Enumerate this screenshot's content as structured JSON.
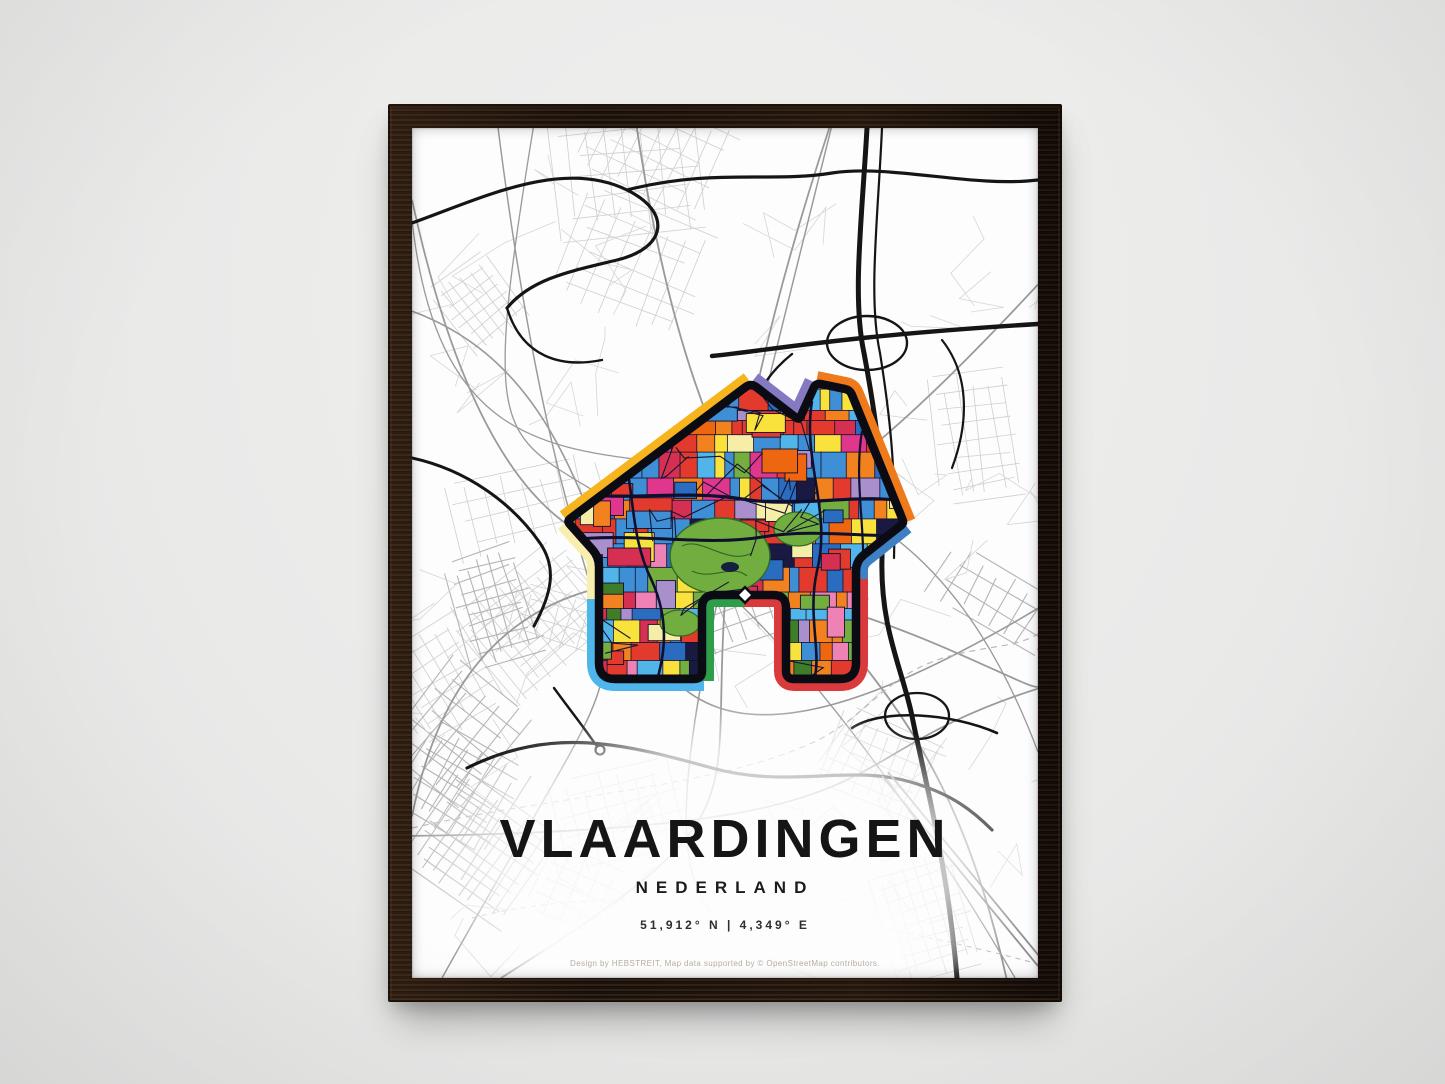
{
  "poster": {
    "title": "VLAARDINGEN",
    "subtitle": "NEDERLAND",
    "coordinates": "51,912° N | 4,349° E",
    "credit": "Design by HEBSTREIT, Map data supported by © OpenStreetMap contributors."
  },
  "colors": {
    "wall": "#eaeae9",
    "frame_wood": "#231710",
    "poster_bg": "#fdfdfd",
    "street_light": "#cfcfcf",
    "street_medium": "#9a9a9a",
    "street_dark": "#151515",
    "boundary_dash": "#b8b8b8",
    "rail_gray": "#8f8f8f"
  },
  "house_icon": {
    "border_segments": [
      {
        "name": "roof-left",
        "color": "#f6b41e"
      },
      {
        "name": "roof-right-upper",
        "color": "#8579c1"
      },
      {
        "name": "chimney-right",
        "color": "#ee7a1b"
      },
      {
        "name": "eave-right",
        "color": "#3e80c3"
      },
      {
        "name": "wall-right-bottom",
        "color": "#da3a3c"
      },
      {
        "name": "door-left",
        "color": "#2f9e4a"
      },
      {
        "name": "leg-left-bottom",
        "color": "#4fb6ec"
      },
      {
        "name": "wall-left",
        "color": "#f8efae"
      }
    ],
    "outline_color": "#0b0b14",
    "street_ink": "#10102c",
    "park_green": "#72ae3f",
    "park_dark": "#2f6b22",
    "marker_color": "#ffffff",
    "mosaic_palette": [
      "#e23b2e",
      "#d53052",
      "#3f8fd6",
      "#2a6cc0",
      "#52b5e9",
      "#f8e23b",
      "#f6eda6",
      "#f2811f",
      "#ee660f",
      "#74ae3f",
      "#3f7d28",
      "#e0368c",
      "#ef82b5",
      "#a98fcb",
      "#191942"
    ]
  }
}
